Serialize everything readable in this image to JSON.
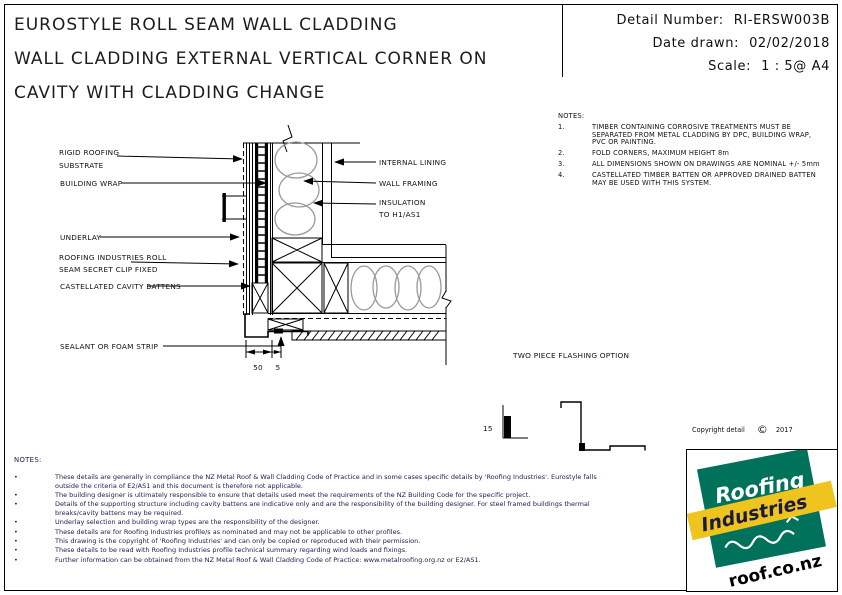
{
  "title": {
    "line1": "EUROSTYLE ROLL SEAM WALL CLADDING",
    "line2": "WALL CLADDING EXTERNAL VERTICAL CORNER ON",
    "line3": "CAVITY WITH CLADDING CHANGE"
  },
  "info": {
    "detail_number_label": "Detail Number:",
    "detail_number": "RI-ERSW003B",
    "date_label": "Date drawn:",
    "date": "02/02/2018",
    "scale_label": "Scale:",
    "scale": "1 : 5@ A4"
  },
  "notes_right": {
    "heading": "NOTES:",
    "items": [
      {
        "num": "1.",
        "text": "TIMBER CONTAINING CORROSIVE TREATMENTS MUST BE SEPARATED FROM METAL CLADDING BY DPC, BUILDING WRAP, PVC OR PAINTING."
      },
      {
        "num": "2.",
        "text": "FOLD CORNERS, MAXIMUM HEIGHT 8m"
      },
      {
        "num": "3.",
        "text": "ALL DIMENSIONS SHOWN ON DRAWINGS ARE NOMINAL +/- 5mm"
      },
      {
        "num": "4.",
        "text": "CASTELLATED TIMBER BATTEN OR APPROVED DRAINED BATTEN MAY BE USED WITH THIS SYSTEM."
      }
    ]
  },
  "drawing": {
    "labels": {
      "rigid1": "RIGID ROOFING",
      "rigid2": "SUBSTRATE",
      "wrap": "BUILDING WRAP",
      "underlay": "UNDERLAY",
      "rollseam1": "ROOFING INDUSTRIES ROLL",
      "rollseam2": "SEAM SECRET CLIP FIXED",
      "battens": "CASTELLATED CAVITY BATTENS",
      "sealant": "SEALANT OR FOAM STRIP",
      "lining": "INTERNAL LINING",
      "framing": "WALL FRAMING",
      "insulation1": "INSULATION",
      "insulation2": "TO H1/AS1",
      "flashing_option": "TWO PIECE FLASHING OPTION"
    },
    "dimensions": {
      "dim50": "50",
      "dim5": "5",
      "dim15": "15"
    }
  },
  "copyright": {
    "text": "Copyright detail",
    "symbol": "©",
    "year": "2017"
  },
  "notes_bottom": {
    "heading": "NOTES:",
    "items": [
      "These details are generally in compliance the NZ Metal Roof & Wall Cladding Code of Practice and in some cases specific details by 'Roofing Industries'.  Eurostyle falls outside the criteria of E2/AS1 and this document is therefore not applicable.",
      "The building designer is ultimately responsible to ensure that details used meet the requirements of the NZ Building Code for the specific project.",
      "Details of the supporting structure including cavity battens are indicative only and are the responsibility of the building designer.  For steel framed buildings thermal breaks/cavity battens may be required.",
      "Underlay selection and building wrap types are the responsibility of the designer.",
      "These details are for Roofing Industries profile/s as nominated and may not be applicable to other profiles.",
      "This drawing is the copyright of 'Roofing Industries' and can only be copied or reproduced with their permission.",
      "These details to be read with Roofing Industries profile technical summary regarding wind loads and fixings.",
      "Further information can be obtained from the NZ Metal Roof & Wall Cladding Code of Practice:  www.metalroofing.org.nz or E2/AS1."
    ]
  },
  "logo": {
    "word1": "Roofing",
    "word2": "Industries",
    "url": "roof.co.nz",
    "green": "#00715A",
    "yellow": "#F0C41E"
  }
}
